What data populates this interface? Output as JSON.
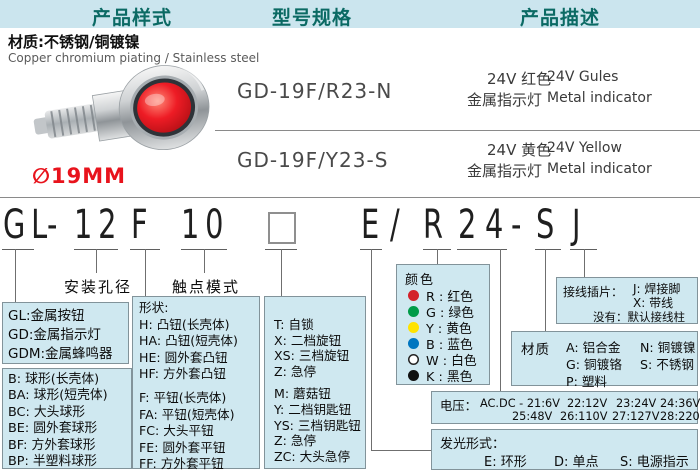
{
  "header": {
    "tabs": [
      "产品样式",
      "型号规格",
      "产品描述"
    ]
  },
  "product": {
    "material_cn": "材质:不锈钢/铜镀镍",
    "material_en": "Copper chromium piating / Stainless  steel",
    "diameter": "∅19MM",
    "photo": "metal-indicator-red-lens"
  },
  "models": [
    {
      "code": "GD-19F/R23-N",
      "cn1": "24V 红色",
      "en1": "24V Gules",
      "cn2": "金属指示灯",
      "en2": "Metal indicator"
    },
    {
      "code": "GD-19F/Y23-S",
      "cn1": "24V 黄色",
      "en1": "24V Yellow",
      "cn2": "金属指示灯",
      "en2": "Metal indicator"
    }
  ],
  "code": {
    "seg": {
      "prefix": "GL",
      "dash1": "-",
      "hole": "12",
      "shape": "F",
      "contact": "10",
      "square": "□",
      "light": "E",
      "slash": "/",
      "color": "R",
      "volt": "24",
      "dash2": "-",
      "material": "S",
      "terminal": "J"
    }
  },
  "labels": {
    "mounting": "安装孔径",
    "contact": "触点模式"
  },
  "boxes": {
    "prefix": {
      "lines": [
        "GL:金属按钮",
        "GD:金属指示灯",
        "GDM:金属蜂鸣器"
      ]
    },
    "ball": {
      "lines": [
        "B: 球形(长壳体)",
        "BA: 球形(短壳体)",
        "BC: 大头球形",
        "BE: 圆外套球形",
        "BF: 方外套球形",
        "BP: 半塑料球形"
      ]
    },
    "shape": {
      "title": "形状:",
      "group1": [
        "H: 凸钮(长壳体)",
        "HA: 凸钮(短壳体)",
        "HE: 圆外套凸钮",
        "HF: 方外套凸钮"
      ],
      "group2": [
        "F: 平钮(长壳体)",
        "FA: 平钮(短壳体)",
        "FC: 大头平钮",
        "FE: 圆外套平钮",
        "FF: 方外套平钮"
      ]
    },
    "contact": {
      "group1": [
        "T: 自锁",
        "X: 二档旋钮",
        "XS: 三档旋钮",
        "Z: 急停"
      ],
      "group2": [
        "M: 蘑菇钮",
        "Y: 二档钥匙钮",
        "YS: 三档钥匙钮",
        "Z: 急停",
        "ZC: 大头急停"
      ]
    },
    "color": {
      "title": "颜色",
      "items": [
        {
          "label": "R : 红色",
          "dot": "background:#d3222a"
        },
        {
          "label": "G : 绿色",
          "dot": "background:#009b48"
        },
        {
          "label": "Y : 黄色",
          "dot": "background:#ffe300"
        },
        {
          "label": "B : 蓝色",
          "dot": "background:#0076c0"
        },
        {
          "label": "W : 白色",
          "dot": "background:#ffffff;box-shadow:inset 0 0 0 1.5px #222"
        },
        {
          "label": "K : 黑色",
          "dot": "background:#111111"
        }
      ]
    },
    "terminal": {
      "label": "接线插片：",
      "j": "J: 焊接脚",
      "x": "X: 带线",
      "none": "没有：默认接线柱"
    },
    "material": {
      "label": "材质",
      "r1c1": "A: 铝合金",
      "r1c2": "N: 铜镀镍",
      "r2c1": "G: 铜镀铬",
      "r2c2": "S: 不锈钢",
      "r3c1": "P: 塑料"
    },
    "voltage": {
      "label": "电压：",
      "prefix": "AC.DC - 21:6V",
      "row1": [
        "22:12V",
        "23:24V",
        "24:36V"
      ],
      "row2": [
        "25:48V",
        "26:110V",
        "27:127V",
        "28:220V"
      ]
    },
    "light": {
      "label": "发光形式：",
      "items": [
        "E: 环形",
        "D: 单点",
        "S: 电源指示"
      ]
    }
  },
  "theme": {
    "band_bg": "#cbe5ee",
    "box_bg": "#cfe8f0",
    "tab_color": "#0b6a64",
    "diameter_color": "#e8131c"
  }
}
